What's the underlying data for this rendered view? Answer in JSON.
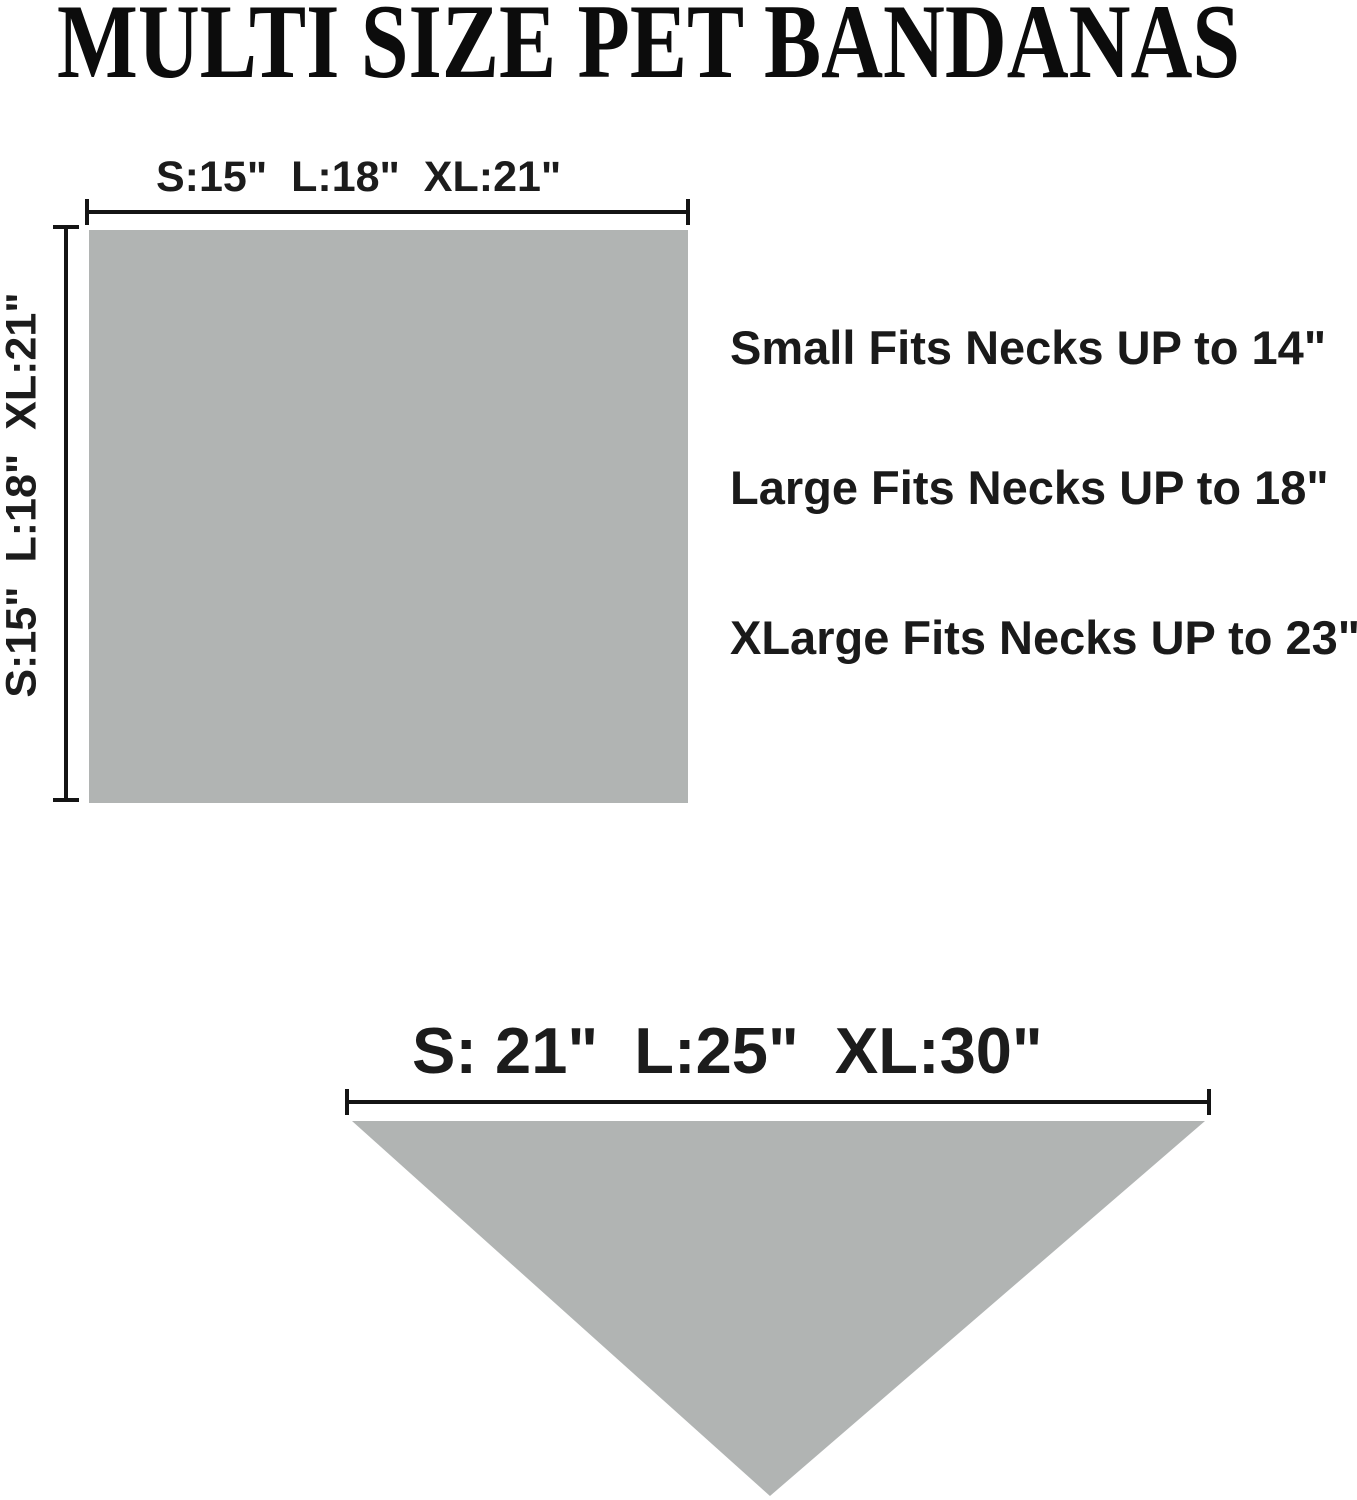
{
  "title": "MULTI SIZE PET BANDANAS",
  "square_diagram": {
    "shape": "square (flat/unfolded bandana)",
    "width_label": "S:15\"  L:18\"  XL:21\"",
    "height_label": "S:15\"  L:18\"  XL:21\"",
    "fill_color": "#b1b4b3"
  },
  "fit_notes": [
    {
      "label": "Small Fits Necks UP to 14\""
    },
    {
      "label": "Large Fits Necks UP to 18\""
    },
    {
      "label": "XLarge Fits Necks UP to 23\""
    }
  ],
  "triangle_diagram": {
    "shape": "triangle (folded bandana, point down)",
    "width_label": "S: 21\"  L:25\"  XL:30\"",
    "fill_color": "#b1b4b3"
  },
  "colors": {
    "background": "#ffffff",
    "text": "#1a1a1a",
    "line": "#141414",
    "bandana_gray": "#b1b4b3"
  }
}
